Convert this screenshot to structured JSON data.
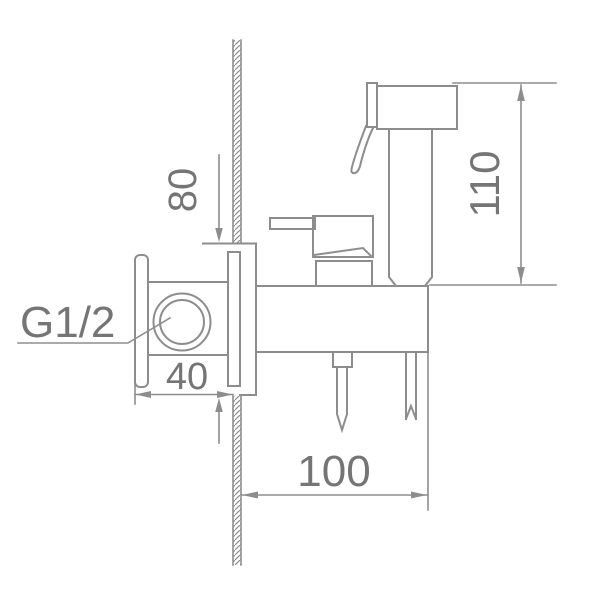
{
  "drawing": {
    "thread_label": "G1/2",
    "dimensions": {
      "sprayer_height": {
        "value": "110"
      },
      "inlet_offset": {
        "value": "80"
      },
      "flange_depth": {
        "value": "40"
      },
      "body_projection": {
        "value": "100"
      }
    },
    "colors": {
      "line": "#8d8d8d",
      "text": "#757575",
      "background": "#ffffff"
    }
  }
}
